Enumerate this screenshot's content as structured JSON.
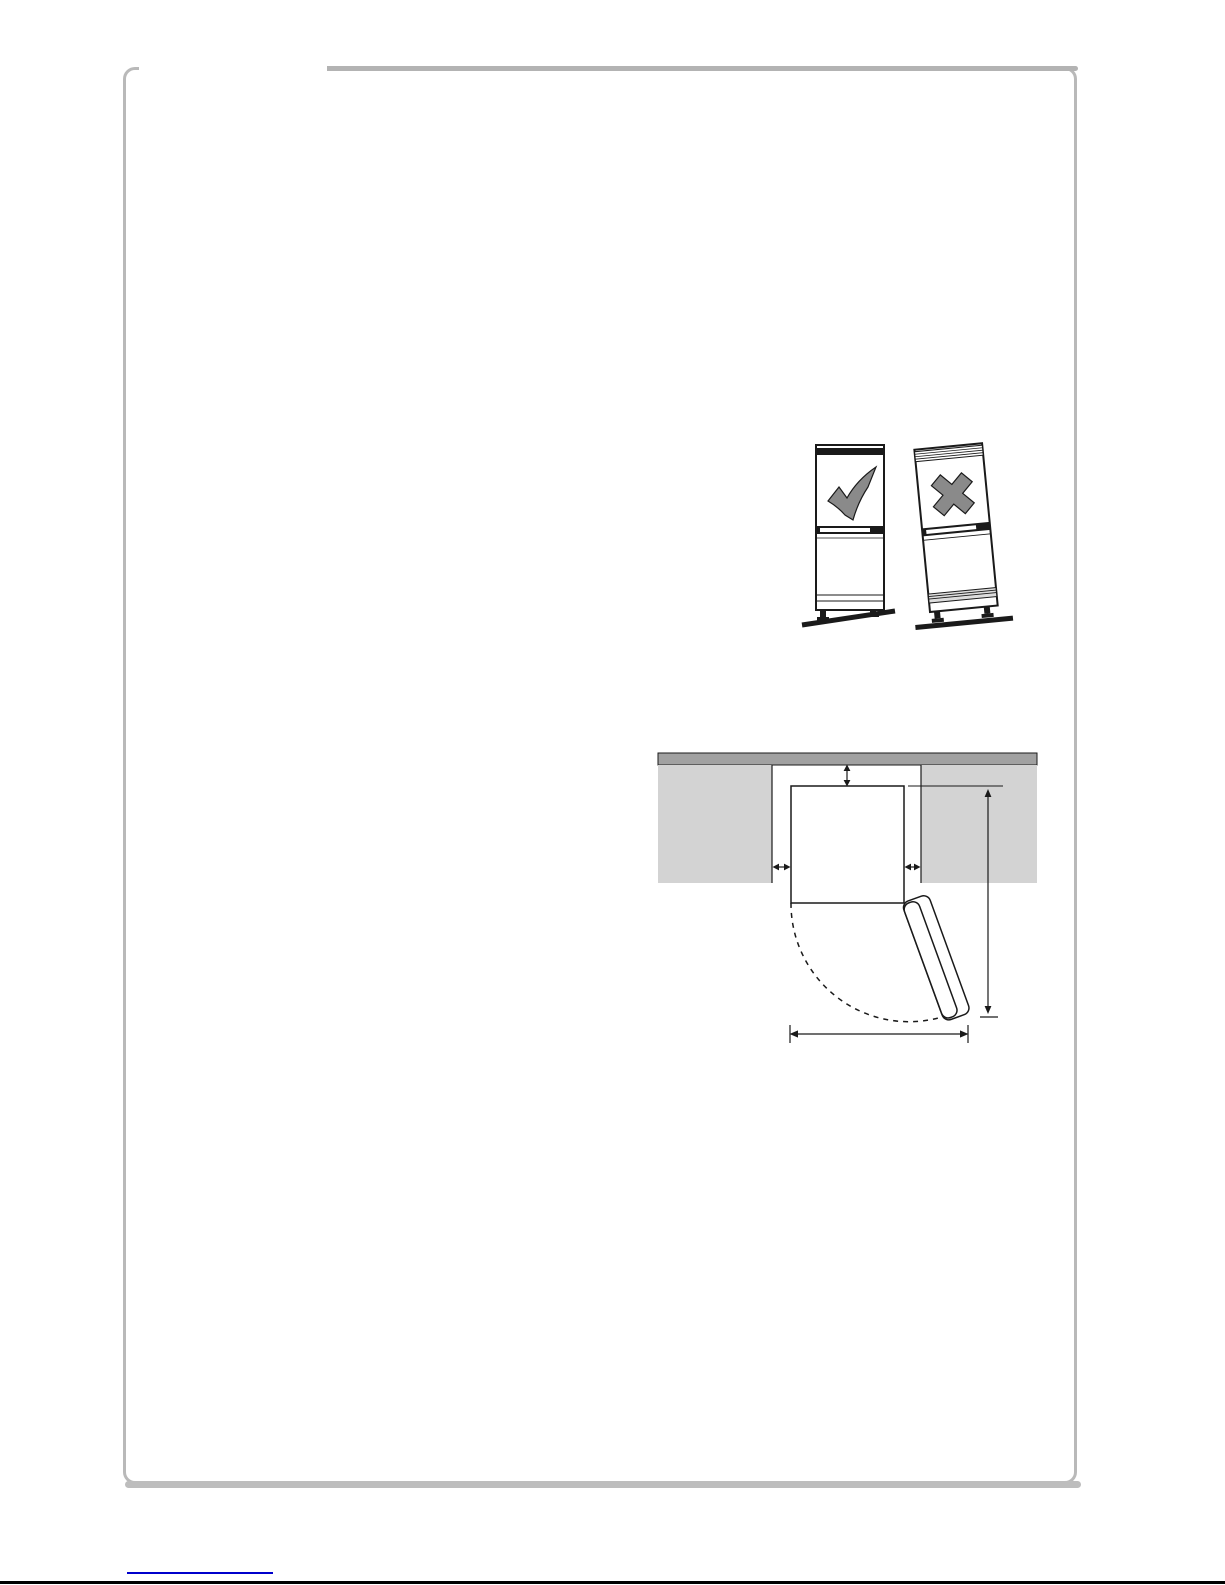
{
  "page": {
    "background_color": "#ffffff",
    "frame_border_color": "#b9b9b9",
    "top_rule_color": "#b3b3b3",
    "bottom_shadow_color": "#bdbdbd",
    "footer_link_color": "#0000cc",
    "footer_rule_color": "#000000"
  },
  "leveling_figure": {
    "description": "refrigerator-leveling-illustration",
    "icons": [
      "check-mark-icon",
      "cross-mark-icon"
    ],
    "check_color": "#8a8a8a",
    "cross_color": "#8a8a8a",
    "outline_color": "#1a1a1a"
  },
  "clearance_figure": {
    "description": "installation-clearance-top-view",
    "wall_color": "#a1a1a1",
    "cabinet_color": "#d3d3d3",
    "line_color": "#1a1a1a"
  }
}
